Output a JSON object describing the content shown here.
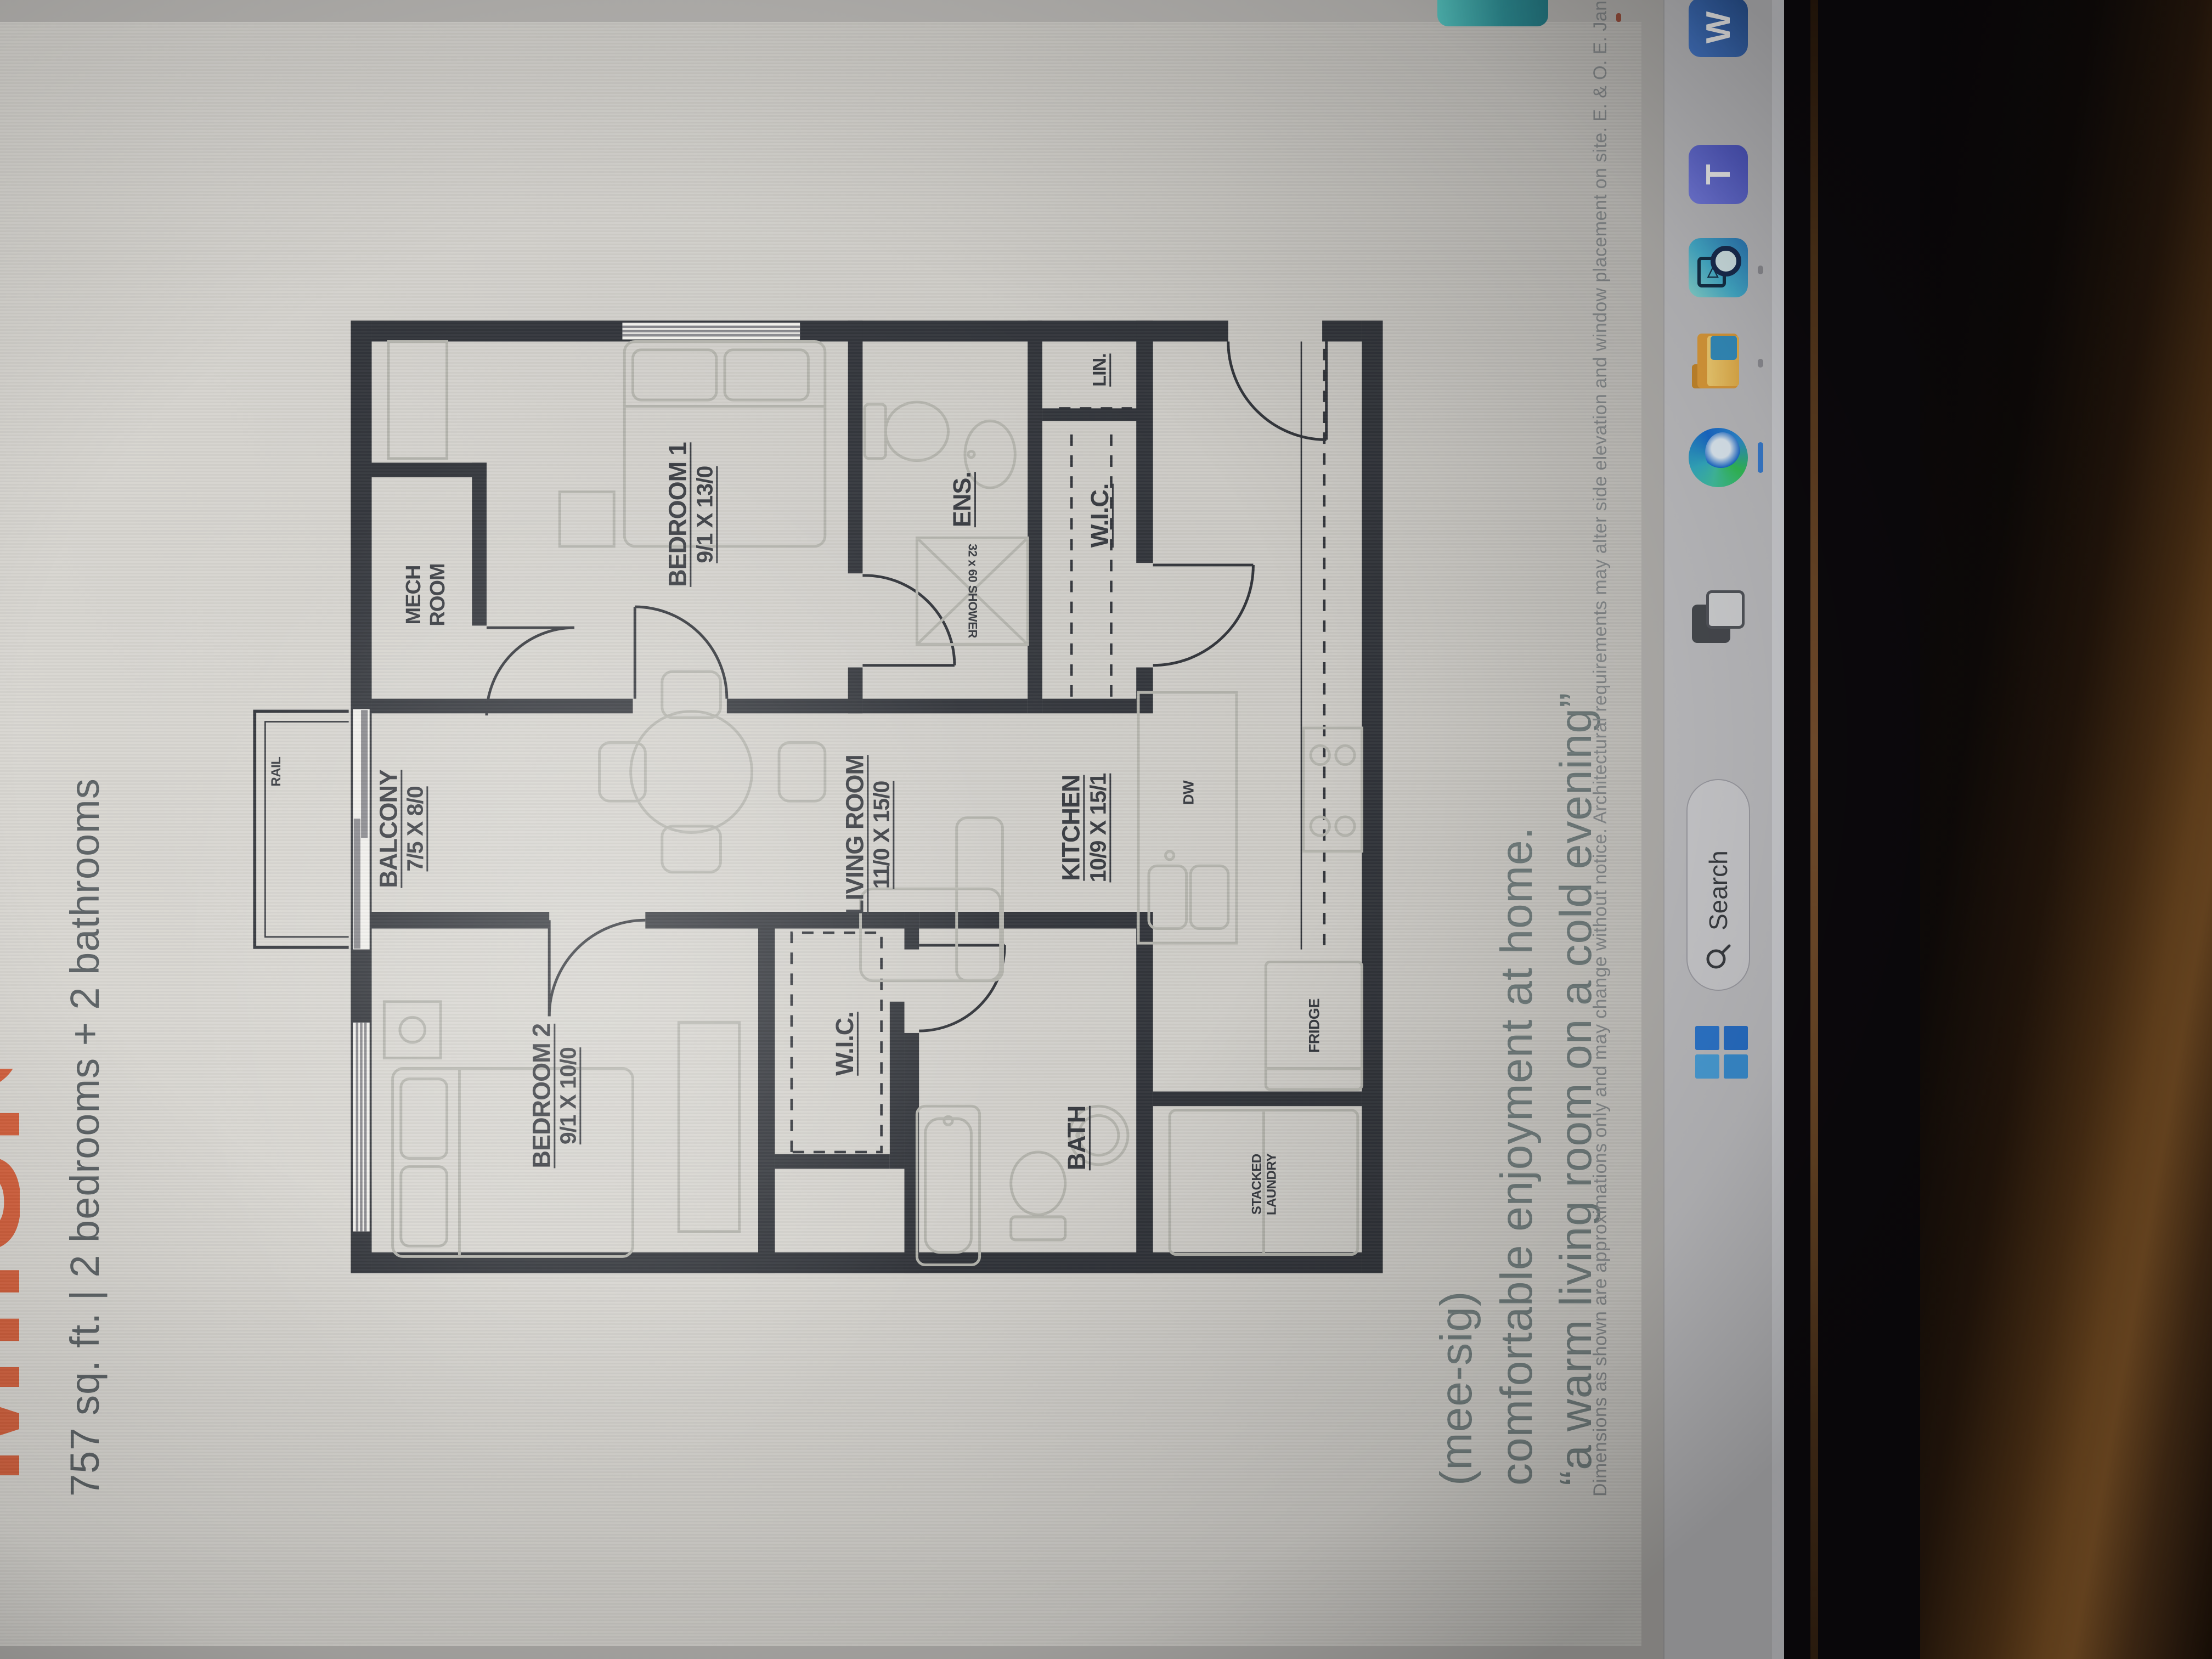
{
  "colors": {
    "accent_orange": "#d45f3b",
    "wall_ink": "#2d3036",
    "edge_blue": "#2f7cd6",
    "teal_accent": "#3fa9a8"
  },
  "document": {
    "title_word": "MIISIG",
    "subtitle": "757 sq. ft.  |  2 bedrooms + 2 bathrooms",
    "pronunciation": "(mee-sig)",
    "tagline_line1": "comfortable enjoyment at home.",
    "tagline_line2": "“a warm living room on a cold evening”",
    "disclaimer": "Dimensions as shown are approximations only and may change without notice. Architectural requirements may alter side elevation and window placement on site. E. & O. E.  Janu",
    "plan": {
      "rooms": [
        {
          "name": "BALCONY",
          "dims": "7/5 X 8/0"
        },
        {
          "name": "BEDROOM 2",
          "dims": "9/1 X 10/0"
        },
        {
          "name": "W.I.C.",
          "dims": ""
        },
        {
          "name": "BATH",
          "dims": ""
        },
        {
          "name": "LIVING ROOM",
          "dims": "11/0 X 15/0"
        },
        {
          "name": "KITCHEN",
          "dims": "10/9 X 15/1"
        },
        {
          "name": "MECH\nROOM",
          "dims": ""
        },
        {
          "name": "BEDROOM 1",
          "dims": "9/1 X 13/0"
        },
        {
          "name": "ENS.",
          "dims": ""
        },
        {
          "name": "W.I.C.",
          "dims": ""
        },
        {
          "name": "LIN.",
          "dims": ""
        }
      ],
      "fixtures": [
        {
          "label": "RAIL"
        },
        {
          "label": "STACKED\nLAUNDRY"
        },
        {
          "label": "FRIDGE"
        },
        {
          "label": "DW"
        },
        {
          "label": "32 x 60 SHOWER"
        }
      ]
    }
  },
  "taskbar": {
    "search_label": "Search",
    "icons": [
      "start",
      "search",
      "task-view",
      "edge",
      "file-explorer",
      "media-app",
      "teams",
      "word"
    ]
  }
}
